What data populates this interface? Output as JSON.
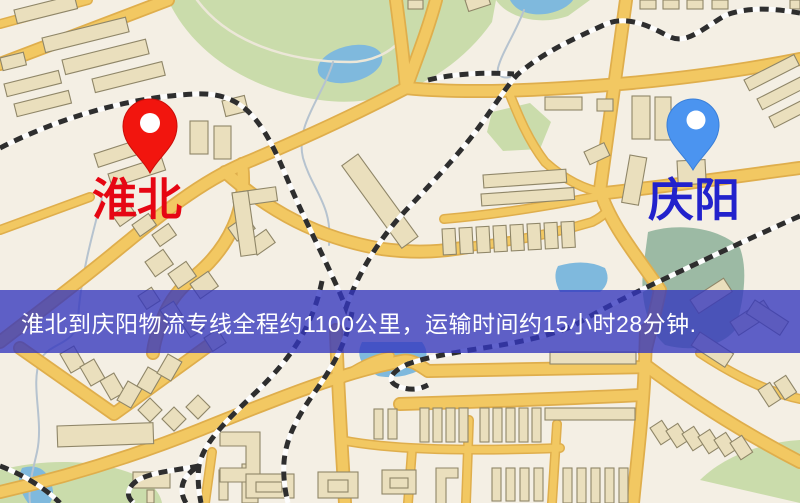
{
  "map": {
    "banner": {
      "text": "淮北到庆阳物流专线全程约1100公里，运输时间约15小时28分钟.",
      "background": "#3336be",
      "opacity": 0.78,
      "text_color": "#ffffff"
    },
    "markers": {
      "origin": {
        "label": "淮北",
        "pin": "red-map-pin"
      },
      "destination": {
        "label": "庆阳",
        "pin": "blue-map-pin"
      }
    },
    "route_summary": {
      "from": "淮北",
      "to": "庆阳",
      "distance_text": "约1100公里",
      "duration_text": "约15小时28分钟"
    },
    "features": [
      "roads",
      "railways",
      "parks",
      "lakes",
      "buildings"
    ]
  },
  "colors": {
    "map_background": "#f4efe4",
    "park": "#cadcab",
    "park_dark": "#9cbaa4",
    "water": "#7fb9dd",
    "road": "#f2c862",
    "road_casing": "#dfae4c",
    "building": "#eadfbd",
    "building_outline": "#8f8668",
    "railway": "#2e2e2e",
    "origin_pin": "#f2150e",
    "origin_label": "#e60613",
    "destination_pin": "#4b94f0",
    "destination_label": "#2222cc"
  }
}
